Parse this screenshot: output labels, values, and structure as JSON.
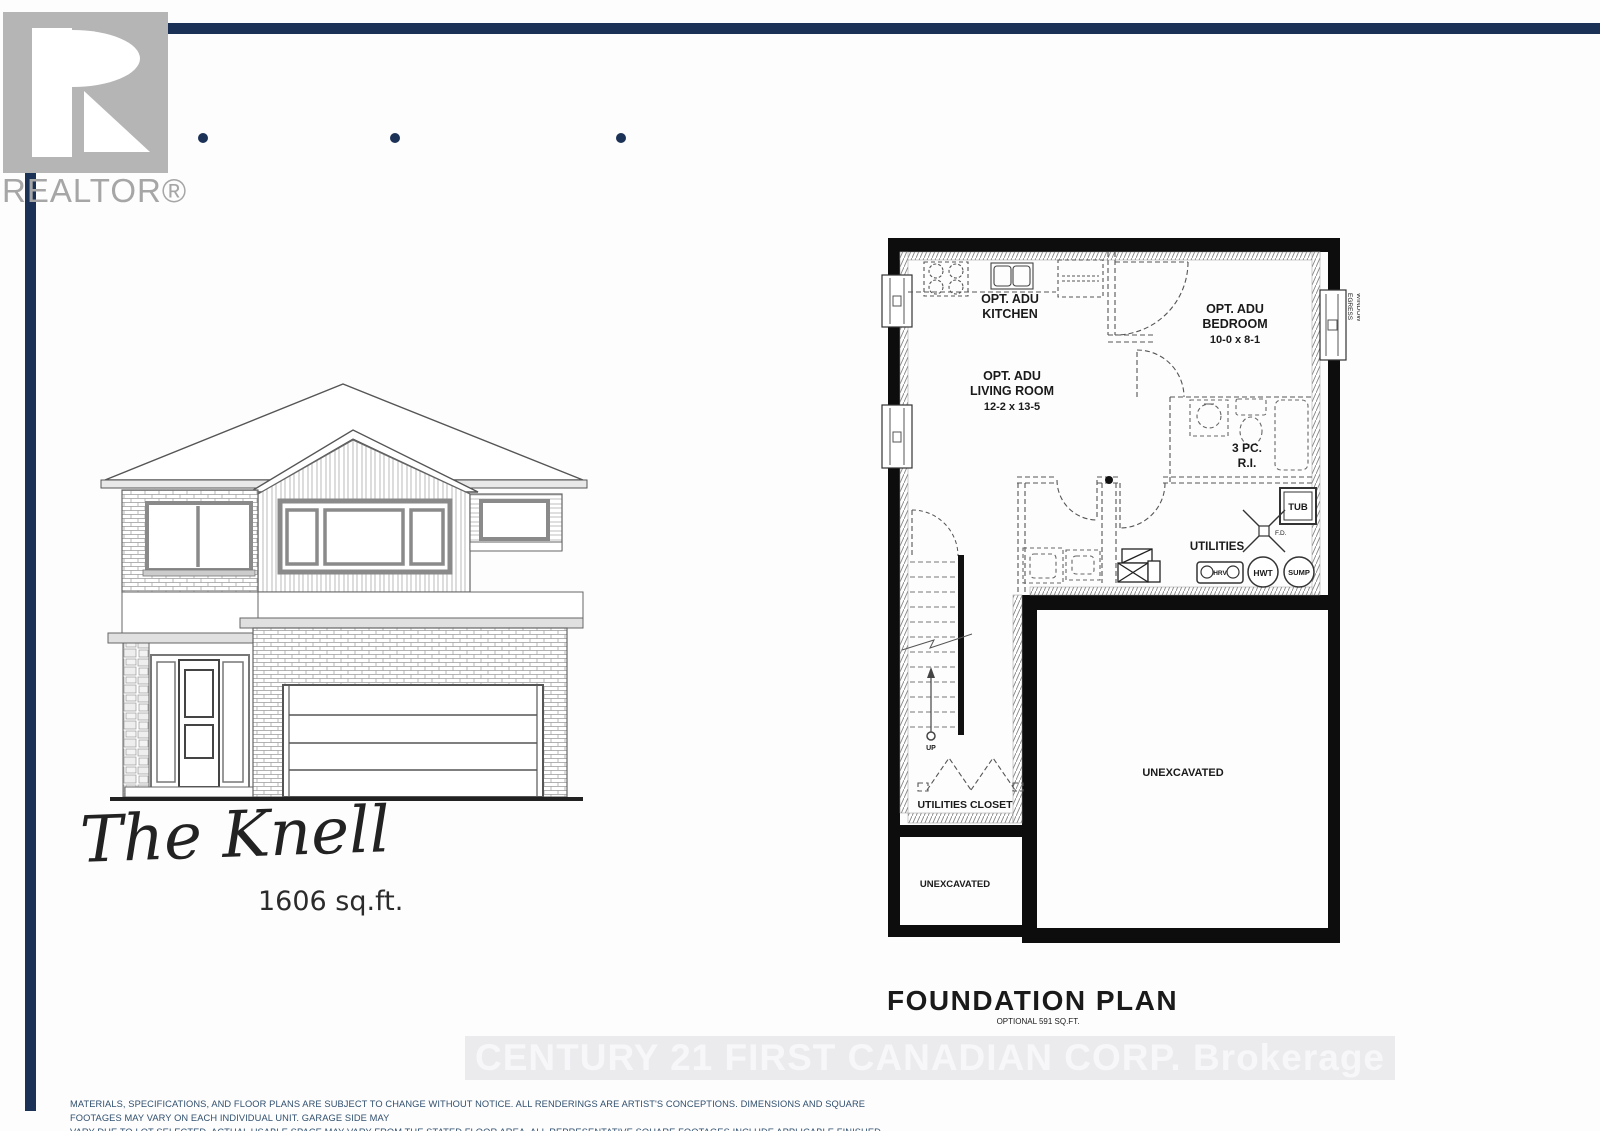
{
  "colors": {
    "navy": "#1b3156",
    "logo_gray": "#b5b5b5",
    "plan_ink": "#0d0d0d"
  },
  "header": {
    "realtor_logo_text": "REALTOR®"
  },
  "hero": {
    "model_name": "The Knell",
    "square_footage": "1606 sq.ft."
  },
  "floor_plan": {
    "title": "FOUNDATION PLAN",
    "subtitle": "OPTIONAL 591 SQ.FT.",
    "rooms": {
      "kitchen_line1": "OPT. ADU",
      "kitchen_line2": "KITCHEN",
      "living_line1": "OPT. ADU",
      "living_line2": "LIVING ROOM",
      "living_dims": "12-2 x 13-5",
      "bedroom_line1": "OPT. ADU",
      "bedroom_line2": "BEDROOM",
      "bedroom_dims": "10-0 x 8-1",
      "bath_line1": "3 PC.",
      "bath_line2": "R.I.",
      "tub": "TUB",
      "floor_drain": "F.D.",
      "utilities": "UTILITIES",
      "hrv": "HRV",
      "hwt": "HWT",
      "sump": "SUMP",
      "stairs_up": "UP",
      "utilities_closet": "UTILITIES CLOSET",
      "unexcavated_small": "UNEXCAVATED",
      "unexcavated_large": "UNEXCAVATED",
      "egress_line1": "EGRESS",
      "egress_line2": "WINDOW"
    }
  },
  "watermark": "CENTURY 21 FIRST CANADIAN CORP. Brokerage",
  "disclaimer": {
    "line1": "MATERIALS, SPECIFICATIONS, AND FLOOR PLANS ARE SUBJECT TO CHANGE WITHOUT NOTICE. ALL RENDERINGS ARE ARTIST'S CONCEPTIONS. DIMENSIONS AND SQUARE FOOTAGES MAY VARY ON EACH INDIVIDUAL UNIT. GARAGE SIDE MAY",
    "line2": "VARY DUE TO LOT SELECTED. ACTUAL USABLE SPACE MAY VARY FROM THE STATED FLOOR AREA. ALL REPRESENTATIVE SQUARE FOOTAGES INCLUDE APPLICABLE FINISHED LOWER LEVEL, OPEN TO BELOW AREAS ARE EXCLUDED. E. &amp; O.E."
  }
}
